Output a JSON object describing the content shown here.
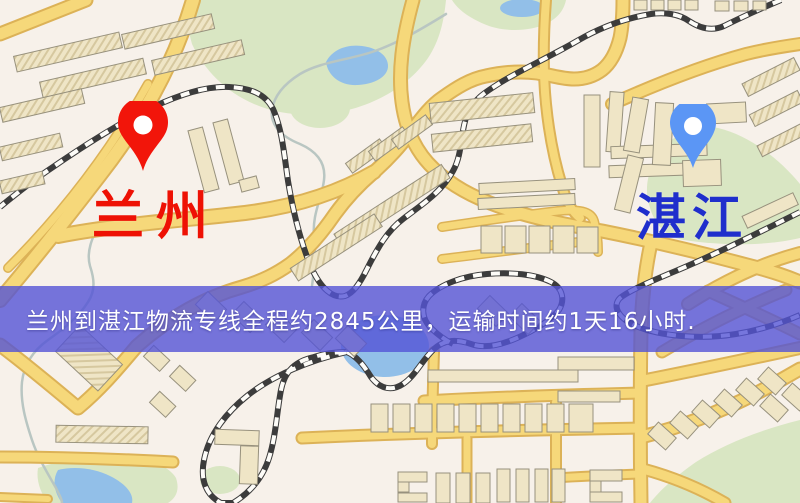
{
  "origin": {
    "name": "兰州"
  },
  "destination": {
    "name": "湛江"
  },
  "banner": {
    "text": "兰州到湛江物流专线全程约2845公里，运输时间约1天16小时."
  },
  "route": {
    "distance_text": "约2845公里",
    "duration_text": "约1天16小时"
  },
  "colors": {
    "origin_pin": "#f2150a",
    "origin_label": "#ee1104",
    "destination_pin": "#5b96f5",
    "destination_label": "#1f2ecc",
    "banner_bg": "#5454d6",
    "banner_text": "#ffffff",
    "road": "#f6d87a",
    "park": "#d9e6c3",
    "water": "#92bfe8"
  }
}
